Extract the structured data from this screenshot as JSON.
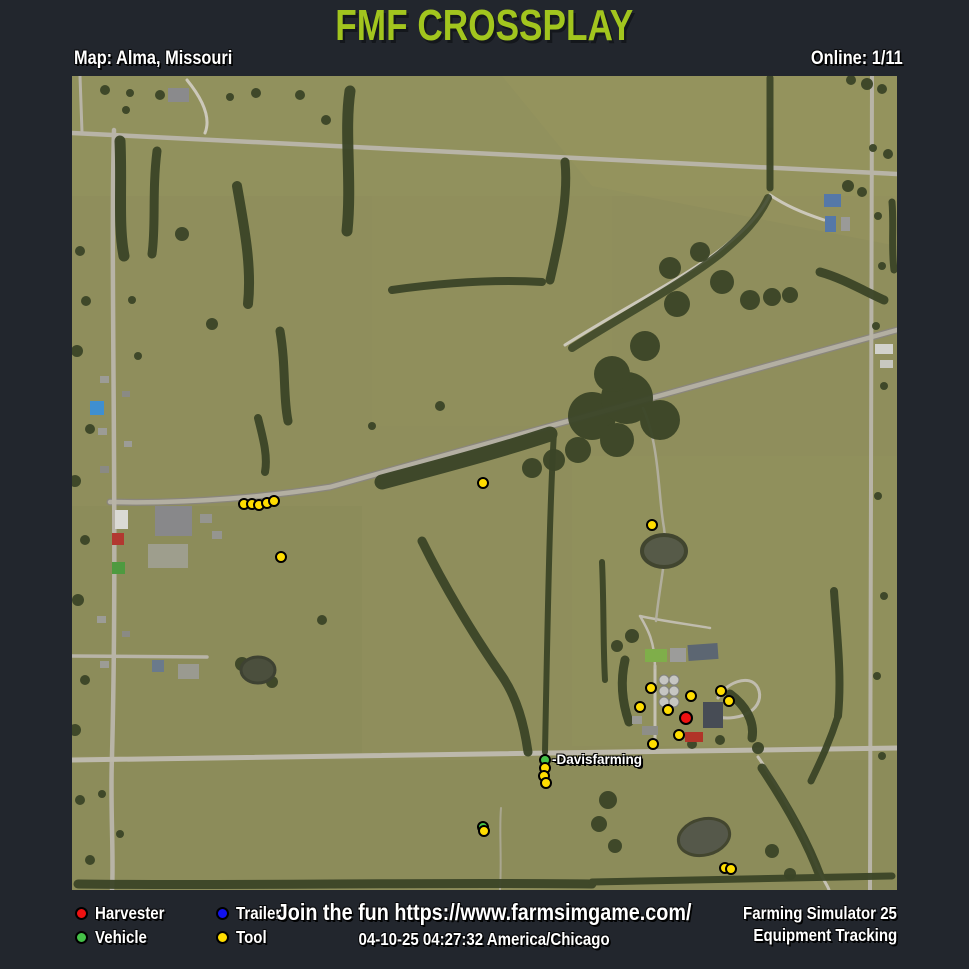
{
  "page": {
    "colors": {
      "accent": "#a2c51e",
      "background": "#22262d",
      "map_base": "#8f8e5c"
    }
  },
  "header": {
    "title": "FMF CROSSPLAY",
    "map_label": "Map: Alma, Missouri",
    "online_label": "Online: 1/11"
  },
  "map": {
    "name": "Alma, Missouri",
    "player_label": "-Davisfarming",
    "markers": [
      {
        "type": "tool",
        "x": 172,
        "y": 428
      },
      {
        "type": "tool",
        "x": 180,
        "y": 428
      },
      {
        "type": "tool",
        "x": 187,
        "y": 429
      },
      {
        "type": "tool",
        "x": 195,
        "y": 427
      },
      {
        "type": "tool",
        "x": 202,
        "y": 425
      },
      {
        "type": "tool",
        "x": 209,
        "y": 481
      },
      {
        "type": "tool",
        "x": 411,
        "y": 407
      },
      {
        "type": "tool",
        "x": 580,
        "y": 449
      },
      {
        "type": "tool",
        "x": 579,
        "y": 612
      },
      {
        "type": "tool",
        "x": 568,
        "y": 631
      },
      {
        "type": "tool",
        "x": 596,
        "y": 634
      },
      {
        "type": "tool",
        "x": 619,
        "y": 620
      },
      {
        "type": "tool",
        "x": 649,
        "y": 615
      },
      {
        "type": "tool",
        "x": 657,
        "y": 625
      },
      {
        "type": "tool",
        "x": 607,
        "y": 659
      },
      {
        "type": "tool",
        "x": 581,
        "y": 668
      },
      {
        "type": "harvester",
        "x": 614,
        "y": 642
      },
      {
        "type": "vehicle",
        "x": 473,
        "y": 684,
        "label": "-Davisfarming"
      },
      {
        "type": "tool",
        "x": 473,
        "y": 692
      },
      {
        "type": "tool",
        "x": 472,
        "y": 700
      },
      {
        "type": "tool",
        "x": 474,
        "y": 707
      },
      {
        "type": "vehicle",
        "x": 411,
        "y": 751
      },
      {
        "type": "tool",
        "x": 412,
        "y": 755
      },
      {
        "type": "tool",
        "x": 653,
        "y": 792
      },
      {
        "type": "tool",
        "x": 659,
        "y": 793
      }
    ]
  },
  "legend": {
    "items": [
      {
        "id": "harvester",
        "label": "Harvester",
        "color": "#ee1111"
      },
      {
        "id": "vehicle",
        "label": "Vehicle",
        "color": "#45c148"
      },
      {
        "id": "trailer",
        "label": "Trailer",
        "color": "#1212ee"
      },
      {
        "id": "tool",
        "label": "Tool",
        "color": "#ffdd00"
      }
    ]
  },
  "footer": {
    "join_text": "Join the fun https://www.farmsimgame.com/",
    "timestamp": "04-10-25 04:27:32 America/Chicago",
    "game": "Farming Simulator 25",
    "subtitle": "Equipment Tracking"
  }
}
